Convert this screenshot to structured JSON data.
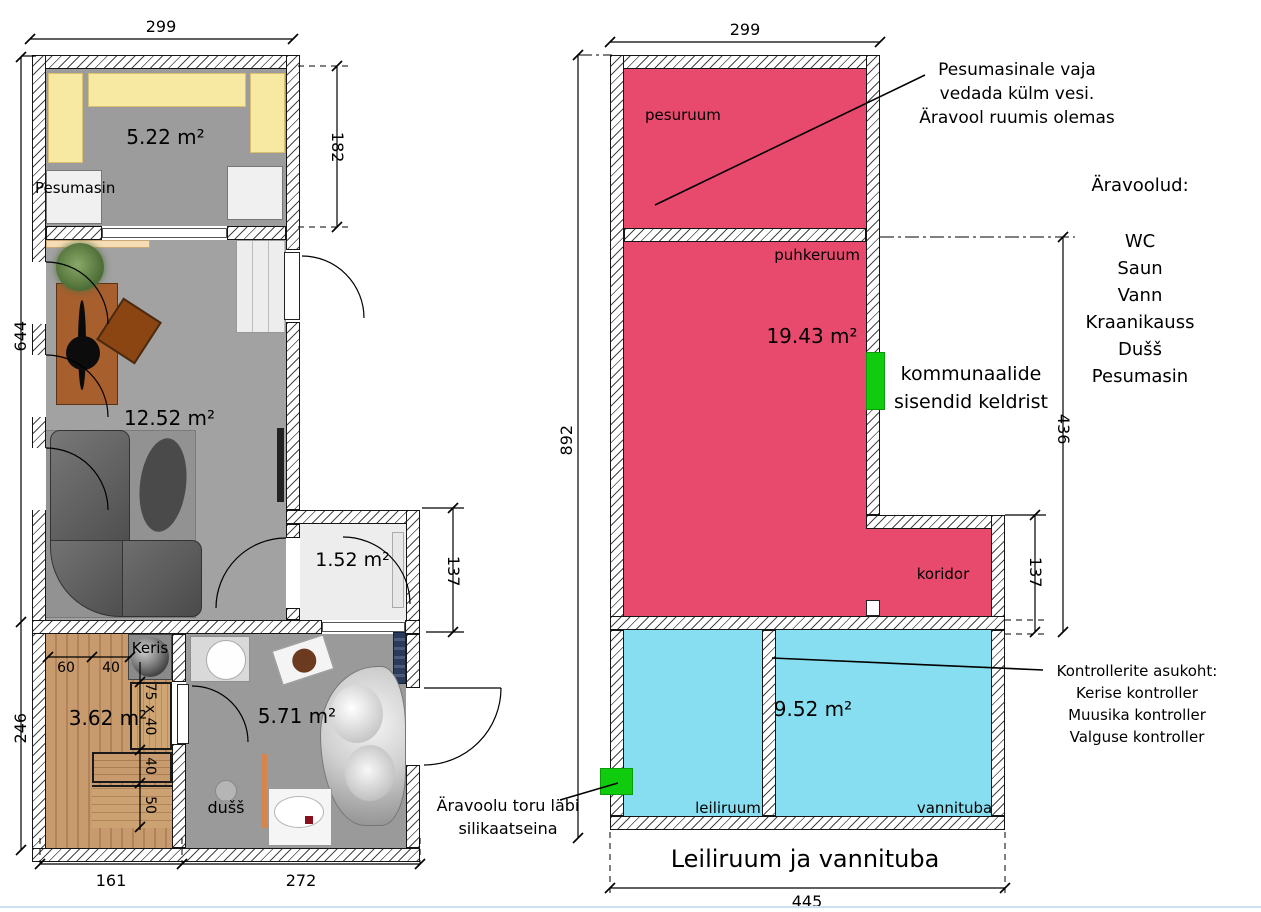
{
  "left_plan": {
    "dims": {
      "top": "299",
      "right": "182",
      "left_upper": "644",
      "left_lower": "246",
      "wc": "137",
      "bottom_left": "161",
      "bottom_right": "272"
    },
    "areas": {
      "laundry": "5.22 m²",
      "living": "12.52 m²",
      "wc": "1.52 m²",
      "sauna": "3.62 m²",
      "bath": "5.71 m²"
    },
    "labels": {
      "washer": "Pesumasin",
      "heater": "Keris",
      "shower": "dušš"
    },
    "sauna_dims": [
      "60",
      "40",
      "75 x 40",
      "40",
      "50"
    ]
  },
  "right_plan": {
    "dims": {
      "top": "299",
      "left": "892",
      "right": "436",
      "corridor": "137",
      "bottom": "445"
    },
    "room_labels": {
      "pesuruum": "pesuruum",
      "puhkeruum": "puhkeruum",
      "koridor": "koridor",
      "leiliruum": "leiliruum",
      "vannituba": "vannituba"
    },
    "areas": {
      "puhkeruum": "19.43 m²",
      "bath_section": "9.52 m²"
    },
    "title": "Leiliruum ja vannituba",
    "notes": {
      "washer": [
        "Pesumasinale vaja",
        "vedada külm vesi.",
        "Äravool ruumis olemas"
      ],
      "drains_heading": "Äravoolud:",
      "drains": [
        "WC",
        "Saun",
        "Vann",
        "Kraanikauss",
        "Dušš",
        "Pesumasin"
      ],
      "utilities": [
        "kommunaalide",
        "sisendid keldrist"
      ],
      "controllers": [
        "Kontrollerite asukoht:",
        "Kerise kontroller",
        "Muusika kontroller",
        "Valguse kontroller"
      ],
      "drain_pipe": [
        "Äravoolu toru läbi",
        "silikaatseina"
      ]
    }
  },
  "colors": {
    "pink": "#e84a6e",
    "blue": "#87def0",
    "green": "#0fcc0f"
  }
}
